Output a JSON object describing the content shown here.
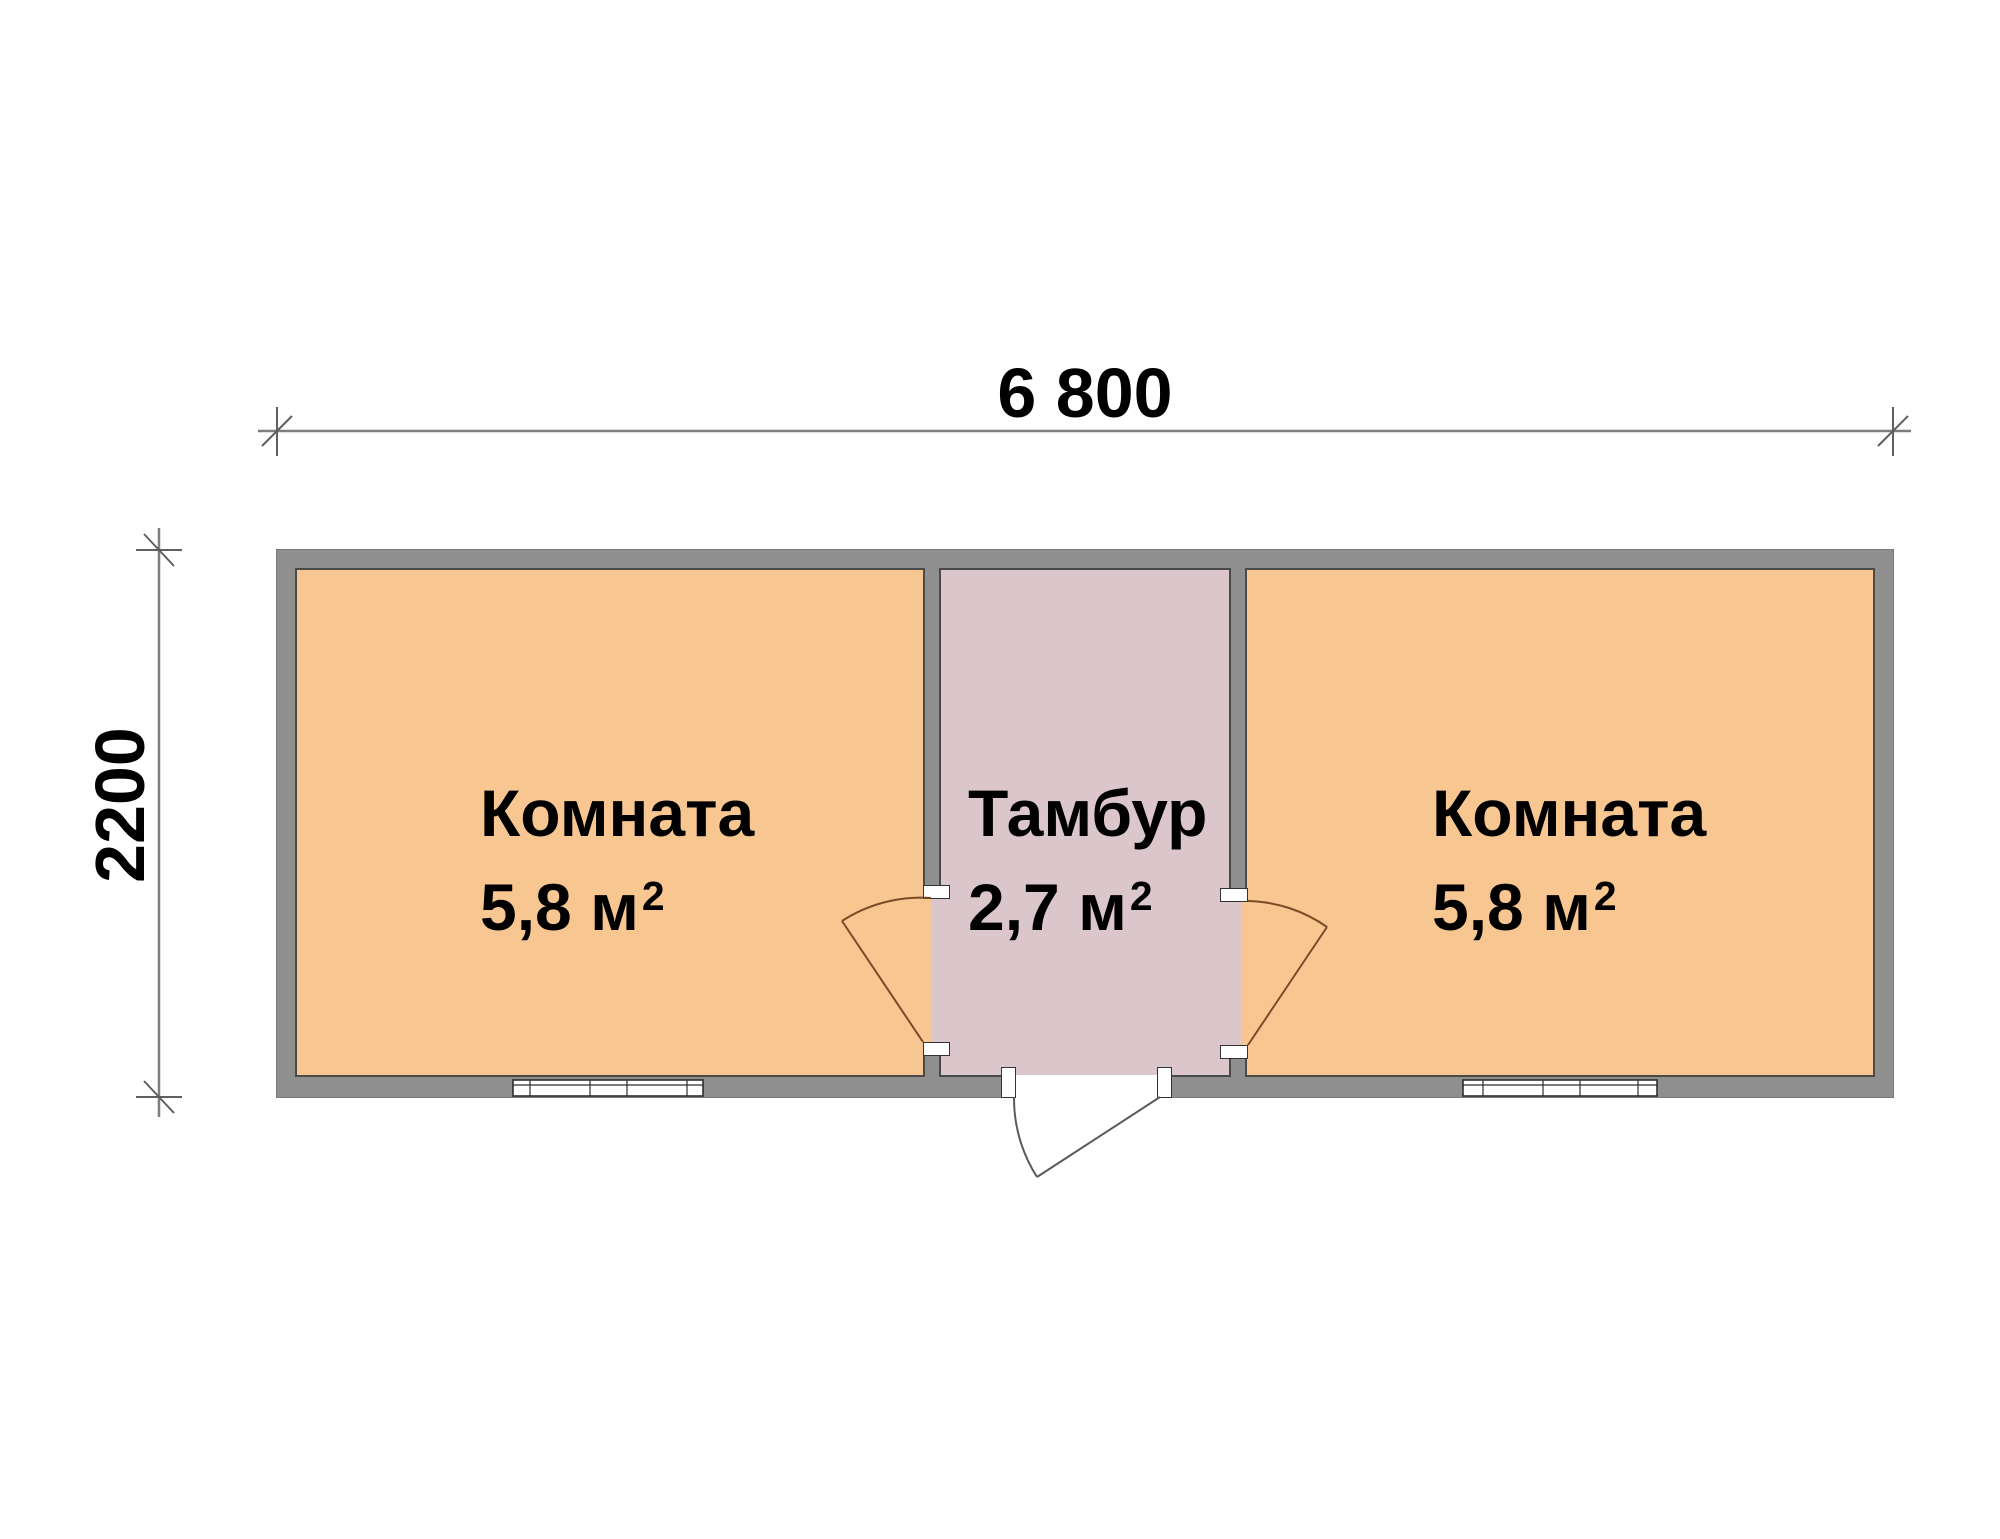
{
  "dimensions": {
    "width_label": "6 800",
    "height_label": "2200"
  },
  "rooms": [
    {
      "name": "Комната",
      "area": "5,8 м",
      "area_sup": "2",
      "fill": "#F8C690"
    },
    {
      "name": "Тамбур",
      "area": "2,7 м",
      "area_sup": "2",
      "fill": "#DBC6CC"
    },
    {
      "name": "Комната",
      "area": "5,8 м",
      "area_sup": "2",
      "fill": "#F8C690"
    }
  ],
  "colors": {
    "wall": "#8F8F8F",
    "wall_edge": "#4a4a4a",
    "room_fill": "#F8C690",
    "vestibule_fill": "#DBC6CC",
    "interior_door_swing": "#7C4A26",
    "entrance_door_swing": "#5A5A5A",
    "dimension_line": "#7D7D7D",
    "window_frame": "#2E2E2E"
  }
}
